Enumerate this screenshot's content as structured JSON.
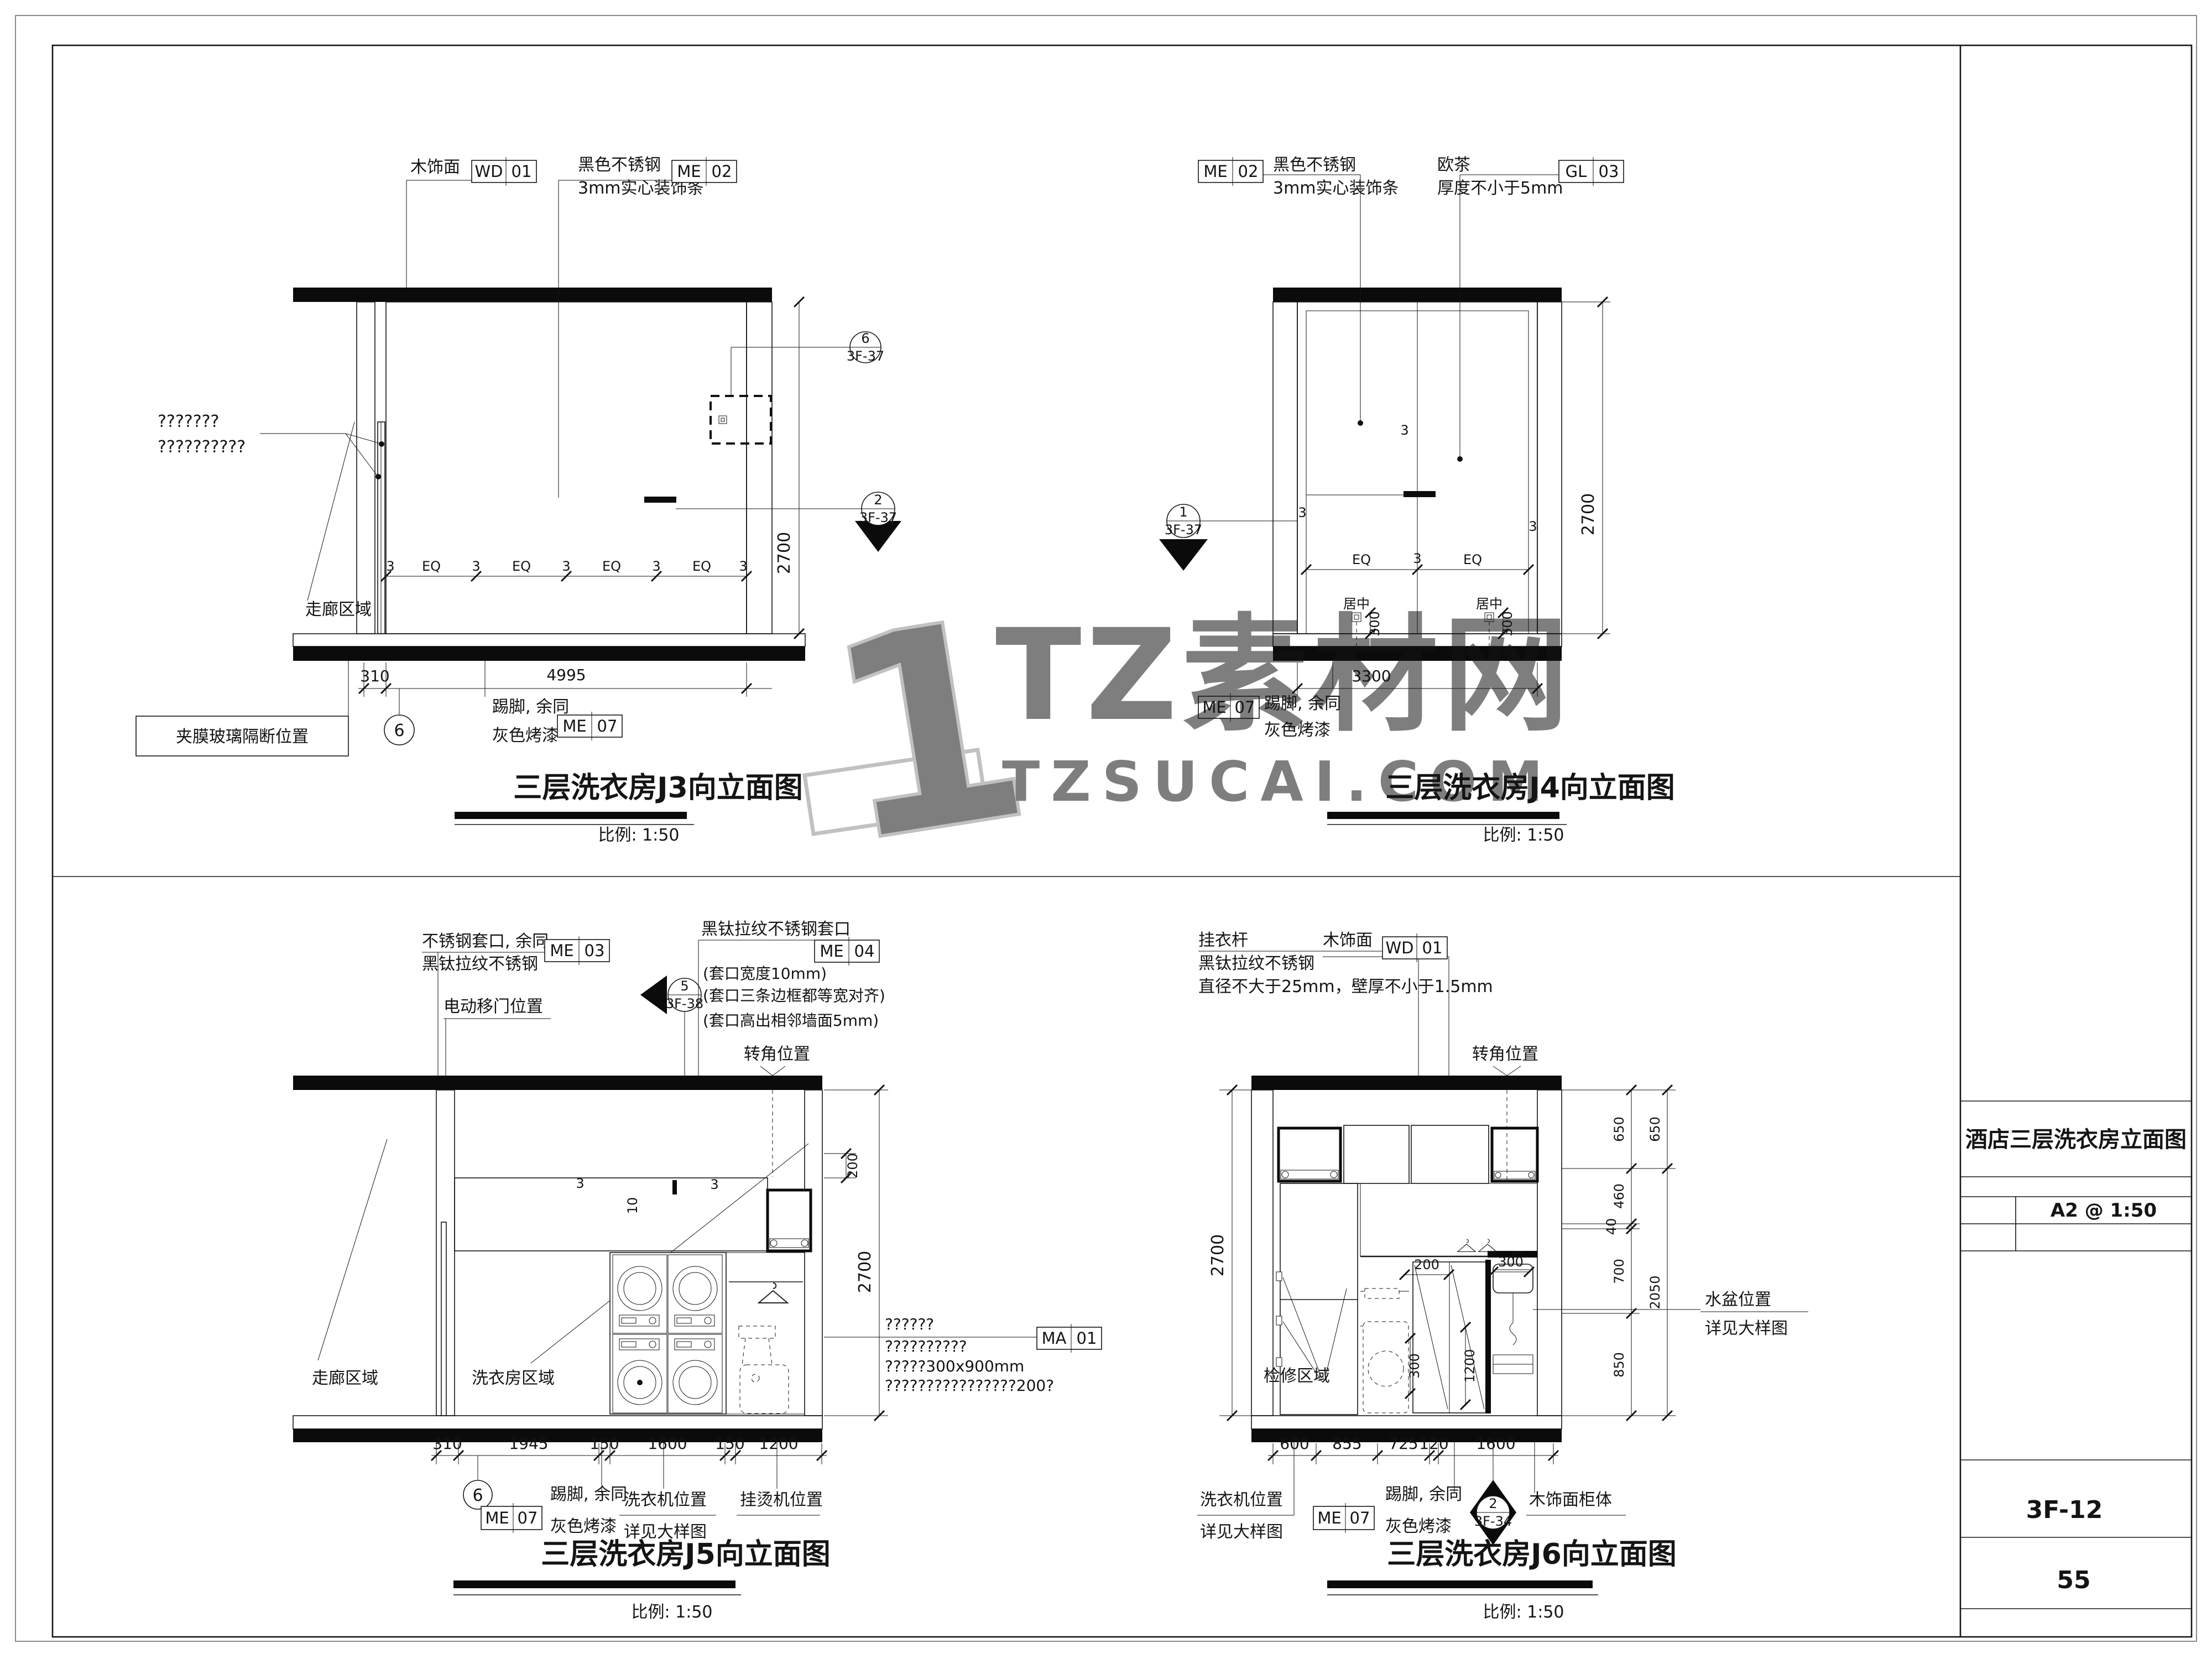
{
  "tb": {
    "title": "酒店三层洗衣房立面图",
    "format": "A2 @ 1:50",
    "no": "3F-12",
    "page": "55"
  },
  "wm": {
    "digit": "1",
    "brand": "TZ素材网",
    "site": "TZSUCAI.COM"
  },
  "scale": "比例: 1:50",
  "mat": {
    "wd01": {
      "c": "WD",
      "n": "01"
    },
    "me02": {
      "c": "ME",
      "n": "02"
    },
    "me03": {
      "c": "ME",
      "n": "03"
    },
    "me04": {
      "c": "ME",
      "n": "04"
    },
    "me07": {
      "c": "ME",
      "n": "07"
    },
    "gl03": {
      "c": "GL",
      "n": "03"
    },
    "ma01": {
      "c": "MA",
      "n": "01"
    }
  },
  "lab": {
    "veneer": "木饰面",
    "blackss": "黑色不锈钢",
    "strip": "3mm实心装饰条",
    "teamirror": "欧茶",
    "thick5": "厚度不小于5mm",
    "skirtA": "踢脚, 余同",
    "skirtB": "灰色烤漆",
    "corridor": "走廊区域",
    "laundry": "洗衣房区域",
    "glasspos": "夹膜玻璃隔断位置",
    "q7": "???????",
    "q10": "??????????",
    "q6": "??????",
    "ma3": "?????300x900mm",
    "ma4": "????????????????200?",
    "frameA": "不锈钢套口, 余同",
    "frameB": "黑钛拉纹不锈钢",
    "doorpos": "电动移门位置",
    "tiframe": "黑钛拉纹不锈钢套口",
    "tin1": "(套口宽度10mm)",
    "tin2": "(套口三条边框都等宽对齐)",
    "tin3": "(套口高出相邻墙面5mm)",
    "cornerpos": "转角位置",
    "rodA": "挂衣杆",
    "rodB": "黑钛拉纹不锈钢",
    "rodC": "直径不大于25mm，壁厚不小于1.5mm",
    "washer": "洗衣机位置",
    "detail": "详见大样图",
    "steamer": "挂烫机位置",
    "basin": "水盆位置",
    "access": "检修区域",
    "woodcab": "木饰面柜体",
    "eq": "EQ",
    "n3": "3",
    "n10": "10",
    "center": "居中"
  },
  "d3": {
    "title": "三层洗衣房J3向立面图",
    "w1": "310",
    "w2": "4995",
    "h": "2700",
    "eq": [
      "3",
      "EQ",
      "3",
      "EQ",
      "3",
      "EQ",
      "3",
      "EQ",
      "3"
    ],
    "mkTop": {
      "n": "6",
      "r": "3F-37"
    },
    "mkMid": {
      "n": "2",
      "r": "3F-37"
    },
    "bubble": "6"
  },
  "d4": {
    "title": "三层洗衣房J4向立面图",
    "w": "3300",
    "h": "2700",
    "eq": [
      "EQ",
      "3",
      "EQ"
    ],
    "jTop": "3",
    "jL": "3",
    "jR": "3",
    "v300": "300",
    "mk": {
      "n": "1",
      "r": "3F-37"
    }
  },
  "d5": {
    "title": "三层洗衣房J5向立面图",
    "bottom": [
      "310",
      "1945",
      "150",
      "1600",
      "150",
      "1200"
    ],
    "top": "200",
    "h": "2700",
    "n10": "10",
    "n3a": "3",
    "n3b": "3",
    "mk": {
      "n": "5",
      "r": "3F-38"
    },
    "bubble": "6"
  },
  "d6": {
    "title": "三层洗衣房J6向立面图",
    "bottom": [
      "600",
      "855",
      "725",
      "120",
      "1600"
    ],
    "inner": [
      "650",
      "460",
      "40",
      "700",
      "850"
    ],
    "outer": [
      "650",
      "2050"
    ],
    "i200": "200",
    "i300a": "300",
    "i300b": "300",
    "i1200": "1200",
    "h": "2700",
    "mk": {
      "n": "2",
      "r": "3F-34"
    }
  }
}
